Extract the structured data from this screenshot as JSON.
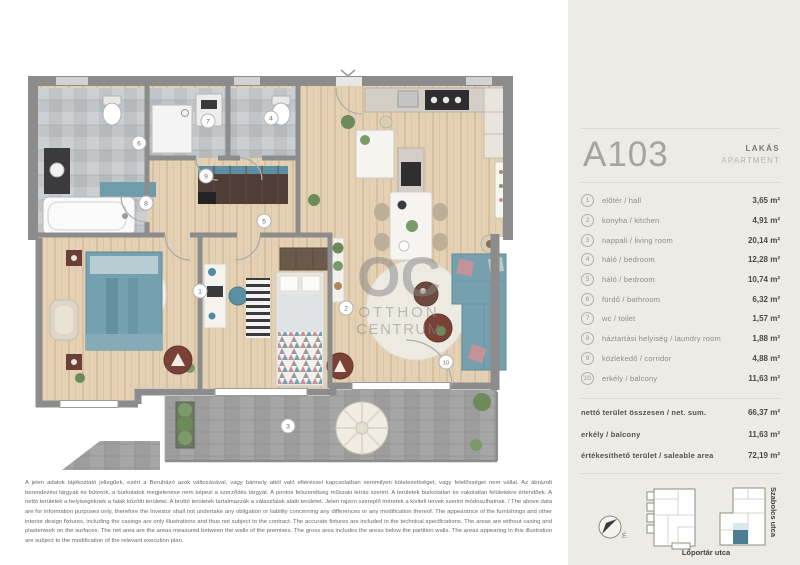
{
  "plan": {
    "watermark": {
      "line1": "OC",
      "line2": "OTTHON",
      "line3": "CENTRUM"
    }
  },
  "sidebar": {
    "unit_id": "A103",
    "type_hu": "LAKÁS",
    "type_en": "APARTMENT",
    "rooms": [
      {
        "num": "1",
        "label": "előtér / hall",
        "area": "3,65 m²"
      },
      {
        "num": "2",
        "label": "konyha / kitchen",
        "area": "4,91 m²"
      },
      {
        "num": "3",
        "label": "nappali / living room",
        "area": "20,14 m²"
      },
      {
        "num": "4",
        "label": "háló / bedroom",
        "area": "12,28 m²"
      },
      {
        "num": "5",
        "label": "háló / bedroom",
        "area": "10,74 m²"
      },
      {
        "num": "6",
        "label": "fürdő / bathroom",
        "area": "6,32 m²"
      },
      {
        "num": "7",
        "label": "wc / toilet",
        "area": "1,57 m²"
      },
      {
        "num": "8",
        "label": "háztartási helyiség / laundry room",
        "area": "1,88 m²"
      },
      {
        "num": "9",
        "label": "közlekedő / corridor",
        "area": "4,88 m²"
      },
      {
        "num": "10",
        "label": "erkély / balcony",
        "area": "11,63 m²"
      }
    ],
    "totals": [
      {
        "label": "nettó terület összesen / net. sum.",
        "value": "66,37 m²"
      },
      {
        "label": "erkély / balcony",
        "value": "11,63 m²"
      },
      {
        "label": "értékesíthető terület / saleable area",
        "value": "72,19 m²"
      }
    ],
    "map": {
      "compass": "É",
      "street_bottom": "Lőportár utca",
      "street_right": "Szabolcs utca",
      "highlight_color": "#4e7d92"
    }
  },
  "disclaimer": "A jelen adatok tájékoztató jellegűek, ezért a Beruházó azok változásával, vagy bármely attól való eltéréssel kapcsolatban semmilyen kötelezettséget, vagy felelősséget nem vállal. Az ábrázolt berendezési tárgyak és bútorok, a burkolatok megjelenése nem képezi a szerződés tárgyát. A pontos felszereltség műszaki leírás szerint. A területek burkolatlan és vakolatlan felületekre értendőek. A nettó területek a helyiségeknek a falak közötti területei. A bruttó területek tartalmazzák a válaszfalak alatti területet. Jelen rajzon szereplő méretek a kiviteli tervek szerint módosulhatnak. / The above data are for information purposes only, therefore the Investor shall not undertake any obligation or liability concerning any differences or any modification thereof. The appearance of the furnishings and other interior design fixtures, including the casings are only illustrations and thus not subject to the contract. The accurate fixtures are included in the technical specifications. The areas are without casing and plasterwork on the surfaces. The net area are the areas measured between the walls of the premises. The gross area includes the areas below the partition walls. The areas appearing in this illustration are subject to the modification of the relevant execution plan."
}
